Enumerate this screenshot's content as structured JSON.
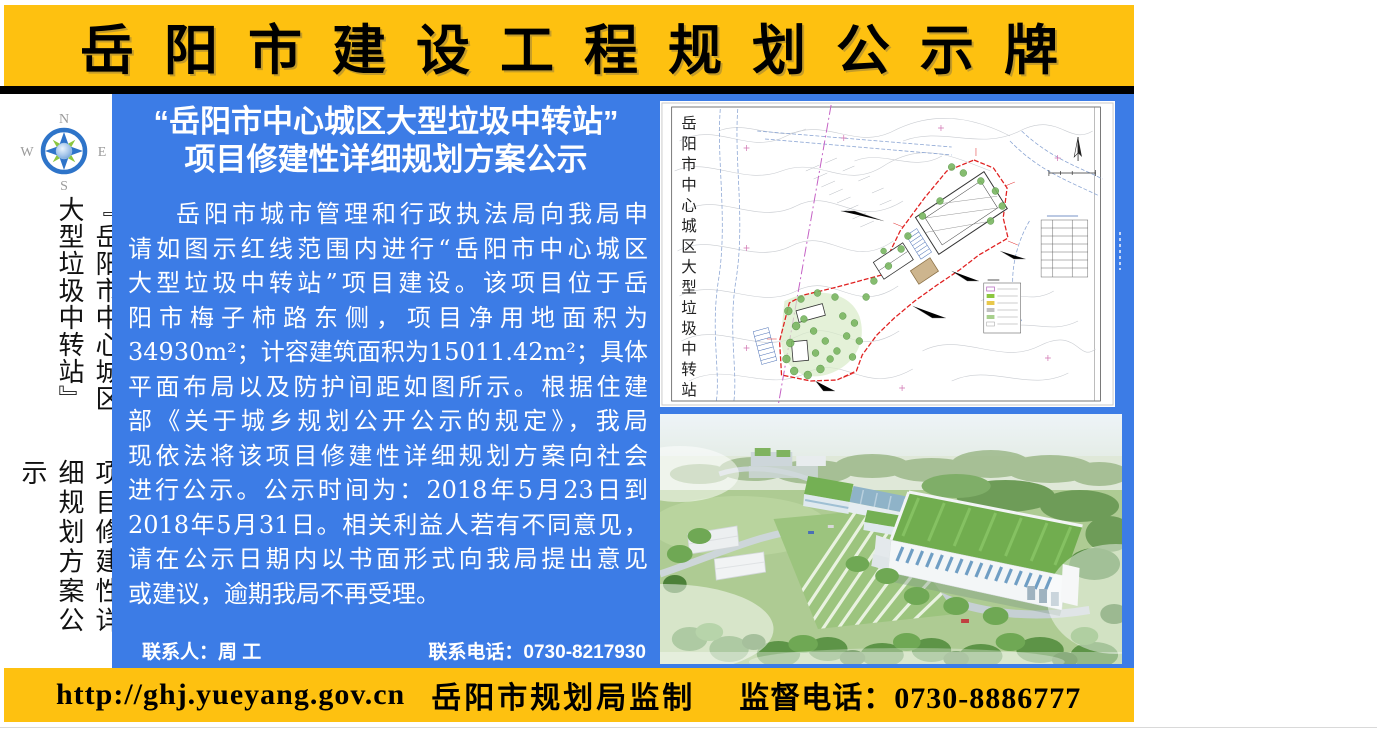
{
  "colors": {
    "banner_yellow": "#FEC110",
    "panel_blue": "#3C7CE6",
    "boundary_red": "#E02020",
    "compass_blue": "#2E74C9",
    "compass_green": "#8CC63F",
    "text_black": "#000000",
    "text_white": "#FFFFFF"
  },
  "header": {
    "title": "岳阳市建设工程规划公示牌"
  },
  "sidebar": {
    "compass": {
      "north": "N",
      "south": "S",
      "east": "E",
      "west": "W"
    },
    "vertical_title_right": "『岳阳市中心城区大型垃圾中转站』",
    "vertical_title_left": "项目修建性详细规划方案公示"
  },
  "notice": {
    "title_line1": "“岳阳市中心城区大型垃圾中转站”",
    "title_line2": "项目修建性详细规划方案公示",
    "body_lines": [
      "岳阳市城市管理和行政执法局向我局申",
      "请如图示红线范围内进行“岳阳市中心城区",
      "大型垃圾中转站”项目建设。该项目位于岳",
      "阳市梅子柿路东侧，项目净用地面积为",
      "34930m²；计容建筑面积为15011.42m²；具体",
      "平面布局以及防护间距如图所示。根据住建",
      "部《关于城乡规划公开公示的规定》，我局",
      "现依法将该项目修建性详细规划方案向社会",
      "进行公示。公示时间为：2018年5月23日到",
      "2018年5月31日。相关利益人若有不同意见，",
      "请在公示日期内以书面形式向我局提出意见",
      "或建议，逾期我局不再受理。"
    ],
    "contact_person": "联系人：周 工",
    "contact_phone": "联系电话：0730-8217930"
  },
  "site_plan": {
    "vertical_label": "岳阳市中心城区大型垃圾中转站"
  },
  "footer": {
    "url": "http://ghj.yueyang.gov.cn",
    "producer": "岳阳市规划局监制",
    "phone": "监督电话：0730-8886777"
  }
}
